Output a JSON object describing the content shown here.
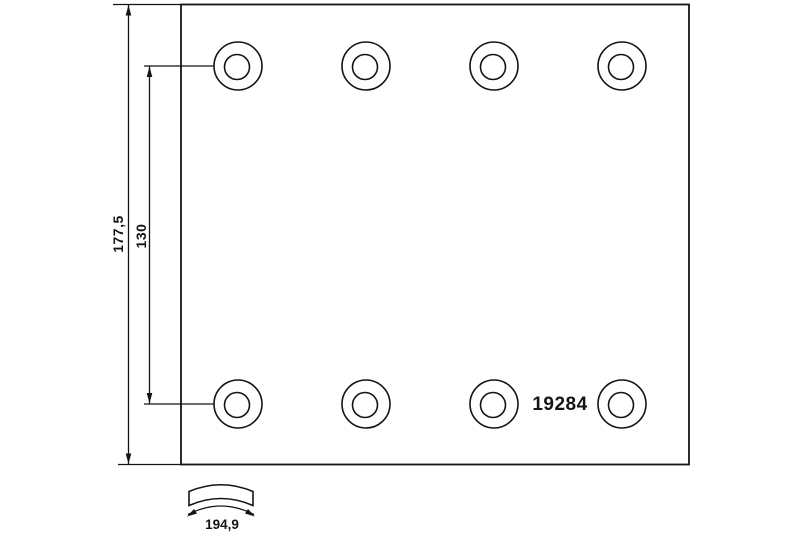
{
  "drawing": {
    "part_number": "19284",
    "dim_height": "177,5",
    "dim_hole_spacing": "130",
    "dim_arc_length": "194,9"
  },
  "colors": {
    "ink": "#141414",
    "background": "#ffffff"
  }
}
